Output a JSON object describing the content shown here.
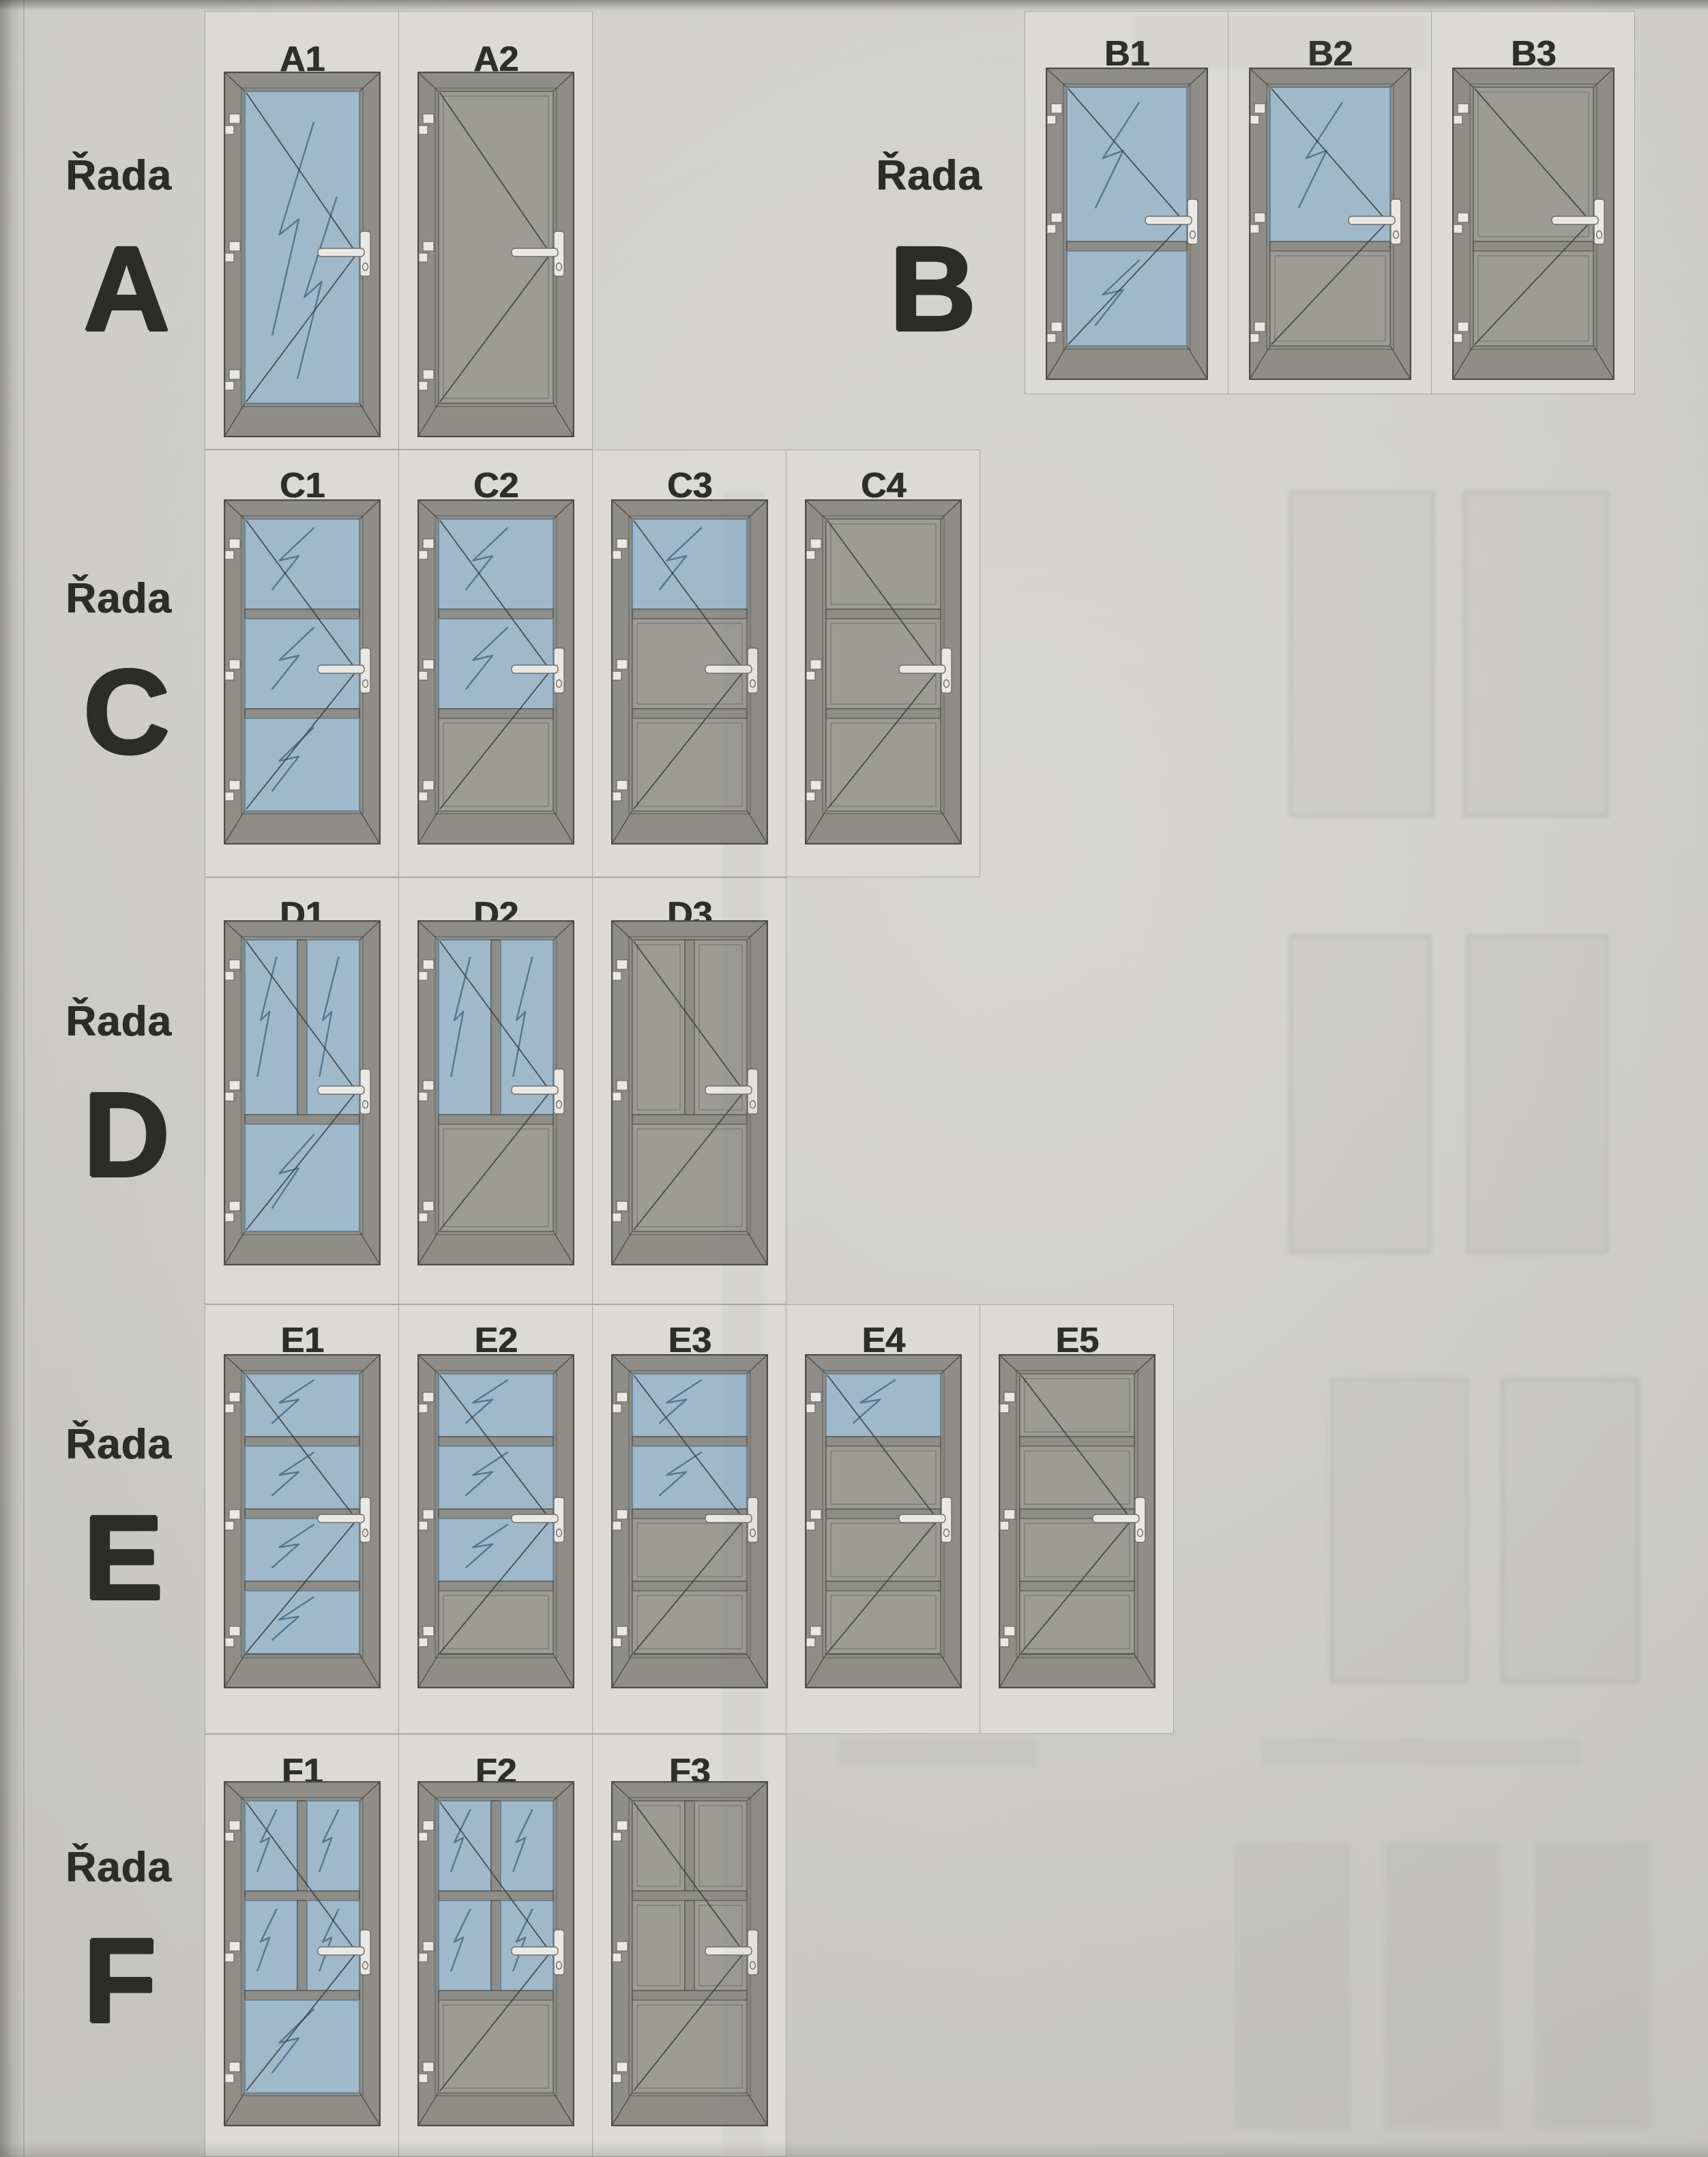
{
  "document": {
    "kind": "scanned door catalog page",
    "language": "cs"
  },
  "colors": {
    "page_bg": "#d3d2cf",
    "cell_bg": "#dbdad7",
    "cell_border": "#a8a7a3",
    "frame": "#8e8d88",
    "frame_outline": "#4e4d49",
    "leaf": "#9b9a94",
    "panel": "#9c9b95",
    "panel_outline": "#63625d",
    "glass": "#9fb9cb",
    "glass_outline": "#627f91",
    "glass_mark": "#3e607a",
    "opening_line": "#3c3c39",
    "hardware": "#e9e8e4",
    "hardware_outline": "#6f6e69",
    "label_text": "#2c2c2a"
  },
  "icons": {
    "hinge": "hinge-icon",
    "handle": "door-handle-icon",
    "glass_mark": "glass-reflection-mark",
    "opening": "opening-direction-lines"
  },
  "rows": [
    {
      "id": "A",
      "prefix": "Řada",
      "letter": "A",
      "doors": [
        {
          "code": "A1",
          "sections": [
            {
              "frac": 1.0,
              "panes": [
                "glass"
              ]
            }
          ]
        },
        {
          "code": "A2",
          "sections": [
            {
              "frac": 1.0,
              "panes": [
                "panel"
              ]
            }
          ]
        }
      ]
    },
    {
      "id": "B",
      "prefix": "Řada",
      "letter": "B",
      "doors": [
        {
          "code": "B1",
          "sections": [
            {
              "frac": 0.62,
              "panes": [
                "glass"
              ]
            },
            {
              "frac": 0.38,
              "panes": [
                "glass"
              ]
            }
          ]
        },
        {
          "code": "B2",
          "sections": [
            {
              "frac": 0.62,
              "panes": [
                "glass"
              ]
            },
            {
              "frac": 0.38,
              "panes": [
                "panel"
              ]
            }
          ]
        },
        {
          "code": "B3",
          "sections": [
            {
              "frac": 0.62,
              "panes": [
                "panel"
              ]
            },
            {
              "frac": 0.38,
              "panes": [
                "panel"
              ]
            }
          ]
        }
      ]
    },
    {
      "id": "C",
      "prefix": "Řada",
      "letter": "C",
      "doors": [
        {
          "code": "C1",
          "sections": [
            {
              "frac": 0.33,
              "panes": [
                "glass"
              ]
            },
            {
              "frac": 0.33,
              "panes": [
                "glass"
              ]
            },
            {
              "frac": 0.34,
              "panes": [
                "glass"
              ]
            }
          ]
        },
        {
          "code": "C2",
          "sections": [
            {
              "frac": 0.33,
              "panes": [
                "glass"
              ]
            },
            {
              "frac": 0.33,
              "panes": [
                "glass"
              ]
            },
            {
              "frac": 0.34,
              "panes": [
                "panel"
              ]
            }
          ]
        },
        {
          "code": "C3",
          "sections": [
            {
              "frac": 0.33,
              "panes": [
                "glass"
              ]
            },
            {
              "frac": 0.33,
              "panes": [
                "panel"
              ]
            },
            {
              "frac": 0.34,
              "panes": [
                "panel"
              ]
            }
          ]
        },
        {
          "code": "C4",
          "sections": [
            {
              "frac": 0.33,
              "panes": [
                "panel"
              ]
            },
            {
              "frac": 0.33,
              "panes": [
                "panel"
              ]
            },
            {
              "frac": 0.34,
              "panes": [
                "panel"
              ]
            }
          ]
        }
      ]
    },
    {
      "id": "D",
      "prefix": "Řada",
      "letter": "D",
      "doors": [
        {
          "code": "D1",
          "sections": [
            {
              "frac": 0.62,
              "panes": [
                "glass",
                "glass"
              ]
            },
            {
              "frac": 0.38,
              "panes": [
                "glass"
              ]
            }
          ]
        },
        {
          "code": "D2",
          "sections": [
            {
              "frac": 0.62,
              "panes": [
                "glass",
                "glass"
              ]
            },
            {
              "frac": 0.38,
              "panes": [
                "panel"
              ]
            }
          ]
        },
        {
          "code": "D3",
          "sections": [
            {
              "frac": 0.62,
              "panes": [
                "panel",
                "panel"
              ]
            },
            {
              "frac": 0.38,
              "panes": [
                "panel"
              ]
            }
          ]
        }
      ]
    },
    {
      "id": "E",
      "prefix": "Řada",
      "letter": "E",
      "doors": [
        {
          "code": "E1",
          "sections": [
            {
              "frac": 0.25,
              "panes": [
                "glass"
              ]
            },
            {
              "frac": 0.25,
              "panes": [
                "glass"
              ]
            },
            {
              "frac": 0.25,
              "panes": [
                "glass"
              ]
            },
            {
              "frac": 0.25,
              "panes": [
                "glass"
              ]
            }
          ]
        },
        {
          "code": "E2",
          "sections": [
            {
              "frac": 0.25,
              "panes": [
                "glass"
              ]
            },
            {
              "frac": 0.25,
              "panes": [
                "glass"
              ]
            },
            {
              "frac": 0.25,
              "panes": [
                "glass"
              ]
            },
            {
              "frac": 0.25,
              "panes": [
                "panel"
              ]
            }
          ]
        },
        {
          "code": "E3",
          "sections": [
            {
              "frac": 0.25,
              "panes": [
                "glass"
              ]
            },
            {
              "frac": 0.25,
              "panes": [
                "glass"
              ]
            },
            {
              "frac": 0.25,
              "panes": [
                "panel"
              ]
            },
            {
              "frac": 0.25,
              "panes": [
                "panel"
              ]
            }
          ]
        },
        {
          "code": "E4",
          "sections": [
            {
              "frac": 0.25,
              "panes": [
                "glass"
              ]
            },
            {
              "frac": 0.25,
              "panes": [
                "panel"
              ]
            },
            {
              "frac": 0.25,
              "panes": [
                "panel"
              ]
            },
            {
              "frac": 0.25,
              "panes": [
                "panel"
              ]
            }
          ]
        },
        {
          "code": "E5",
          "sections": [
            {
              "frac": 0.25,
              "panes": [
                "panel"
              ]
            },
            {
              "frac": 0.25,
              "panes": [
                "panel"
              ]
            },
            {
              "frac": 0.25,
              "panes": [
                "panel"
              ]
            },
            {
              "frac": 0.25,
              "panes": [
                "panel"
              ]
            }
          ]
        }
      ]
    },
    {
      "id": "F",
      "prefix": "Řada",
      "letter": "F",
      "doors": [
        {
          "code": "F1",
          "sections": [
            {
              "frac": 0.33,
              "panes": [
                "glass",
                "glass"
              ]
            },
            {
              "frac": 0.33,
              "panes": [
                "glass",
                "glass"
              ]
            },
            {
              "frac": 0.34,
              "panes": [
                "glass"
              ]
            }
          ]
        },
        {
          "code": "F2",
          "sections": [
            {
              "frac": 0.33,
              "panes": [
                "glass",
                "glass"
              ]
            },
            {
              "frac": 0.33,
              "panes": [
                "glass",
                "glass"
              ]
            },
            {
              "frac": 0.34,
              "panes": [
                "panel"
              ]
            }
          ]
        },
        {
          "code": "F3",
          "sections": [
            {
              "frac": 0.33,
              "panes": [
                "panel",
                "panel"
              ]
            },
            {
              "frac": 0.33,
              "panes": [
                "panel",
                "panel"
              ]
            },
            {
              "frac": 0.34,
              "panes": [
                "panel"
              ]
            }
          ]
        }
      ]
    }
  ]
}
